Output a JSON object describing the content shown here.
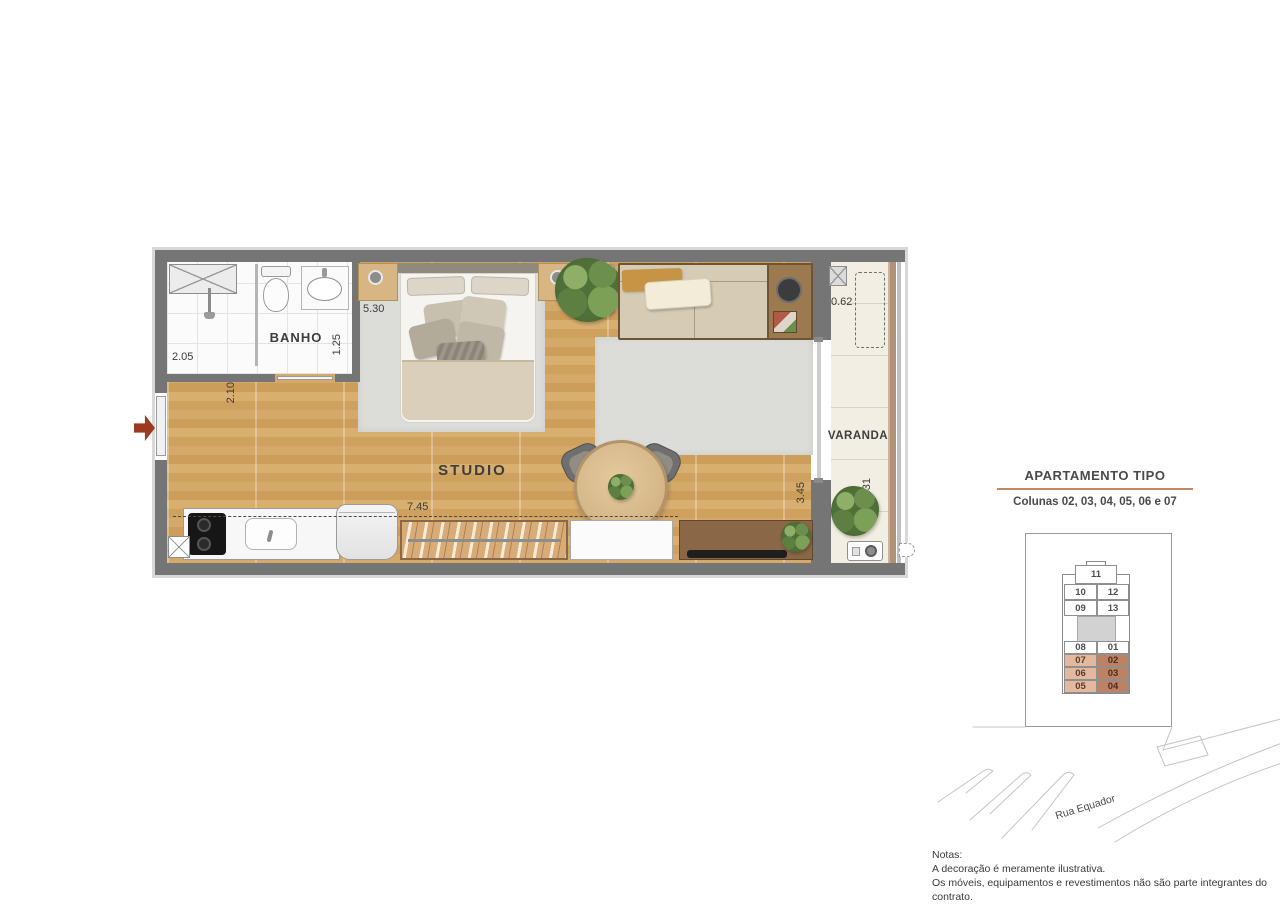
{
  "plan": {
    "rooms": {
      "banho": "BANHO",
      "studio": "STUDIO",
      "varanda": "VARANDA"
    },
    "dims": {
      "shower": "2.05",
      "bath": "1.25",
      "entry": "2.10",
      "bed": "5.30",
      "varanda_depth": "0.62",
      "closet": "7.45",
      "living": "3.45",
      "varanda": "3.31"
    }
  },
  "side_panel": {
    "title": "APARTAMENTO TIPO",
    "subtitle": "Colunas 02, 03, 04, 05, 06 e 07",
    "key_plan": {
      "top_unit": "11",
      "left_units": [
        "10",
        "09",
        "08",
        "07",
        "06",
        "05"
      ],
      "right_units": [
        "12",
        "13",
        "01",
        "02",
        "03",
        "04"
      ],
      "highlighted_units": [
        "02",
        "03",
        "04",
        "05",
        "06",
        "07"
      ]
    },
    "street": "Rua Equador"
  },
  "notes": {
    "title": "Notas:",
    "lines": [
      "A decoração é meramente ilustrativa.",
      "Os móveis, equipamentos e revestimentos não são parte integrantes do contrato.",
      "As cotas são de parede acabada, podendo sofrer alteração no decorrer da obra."
    ]
  },
  "colors": {
    "wall": "#757575",
    "wood_floor": "#e8cfa3",
    "highlight_light": "#e3b89f",
    "highlight_dark": "#bd8164",
    "title_underline": "#c9885c",
    "entry_arrow": "#9c3a1d"
  }
}
